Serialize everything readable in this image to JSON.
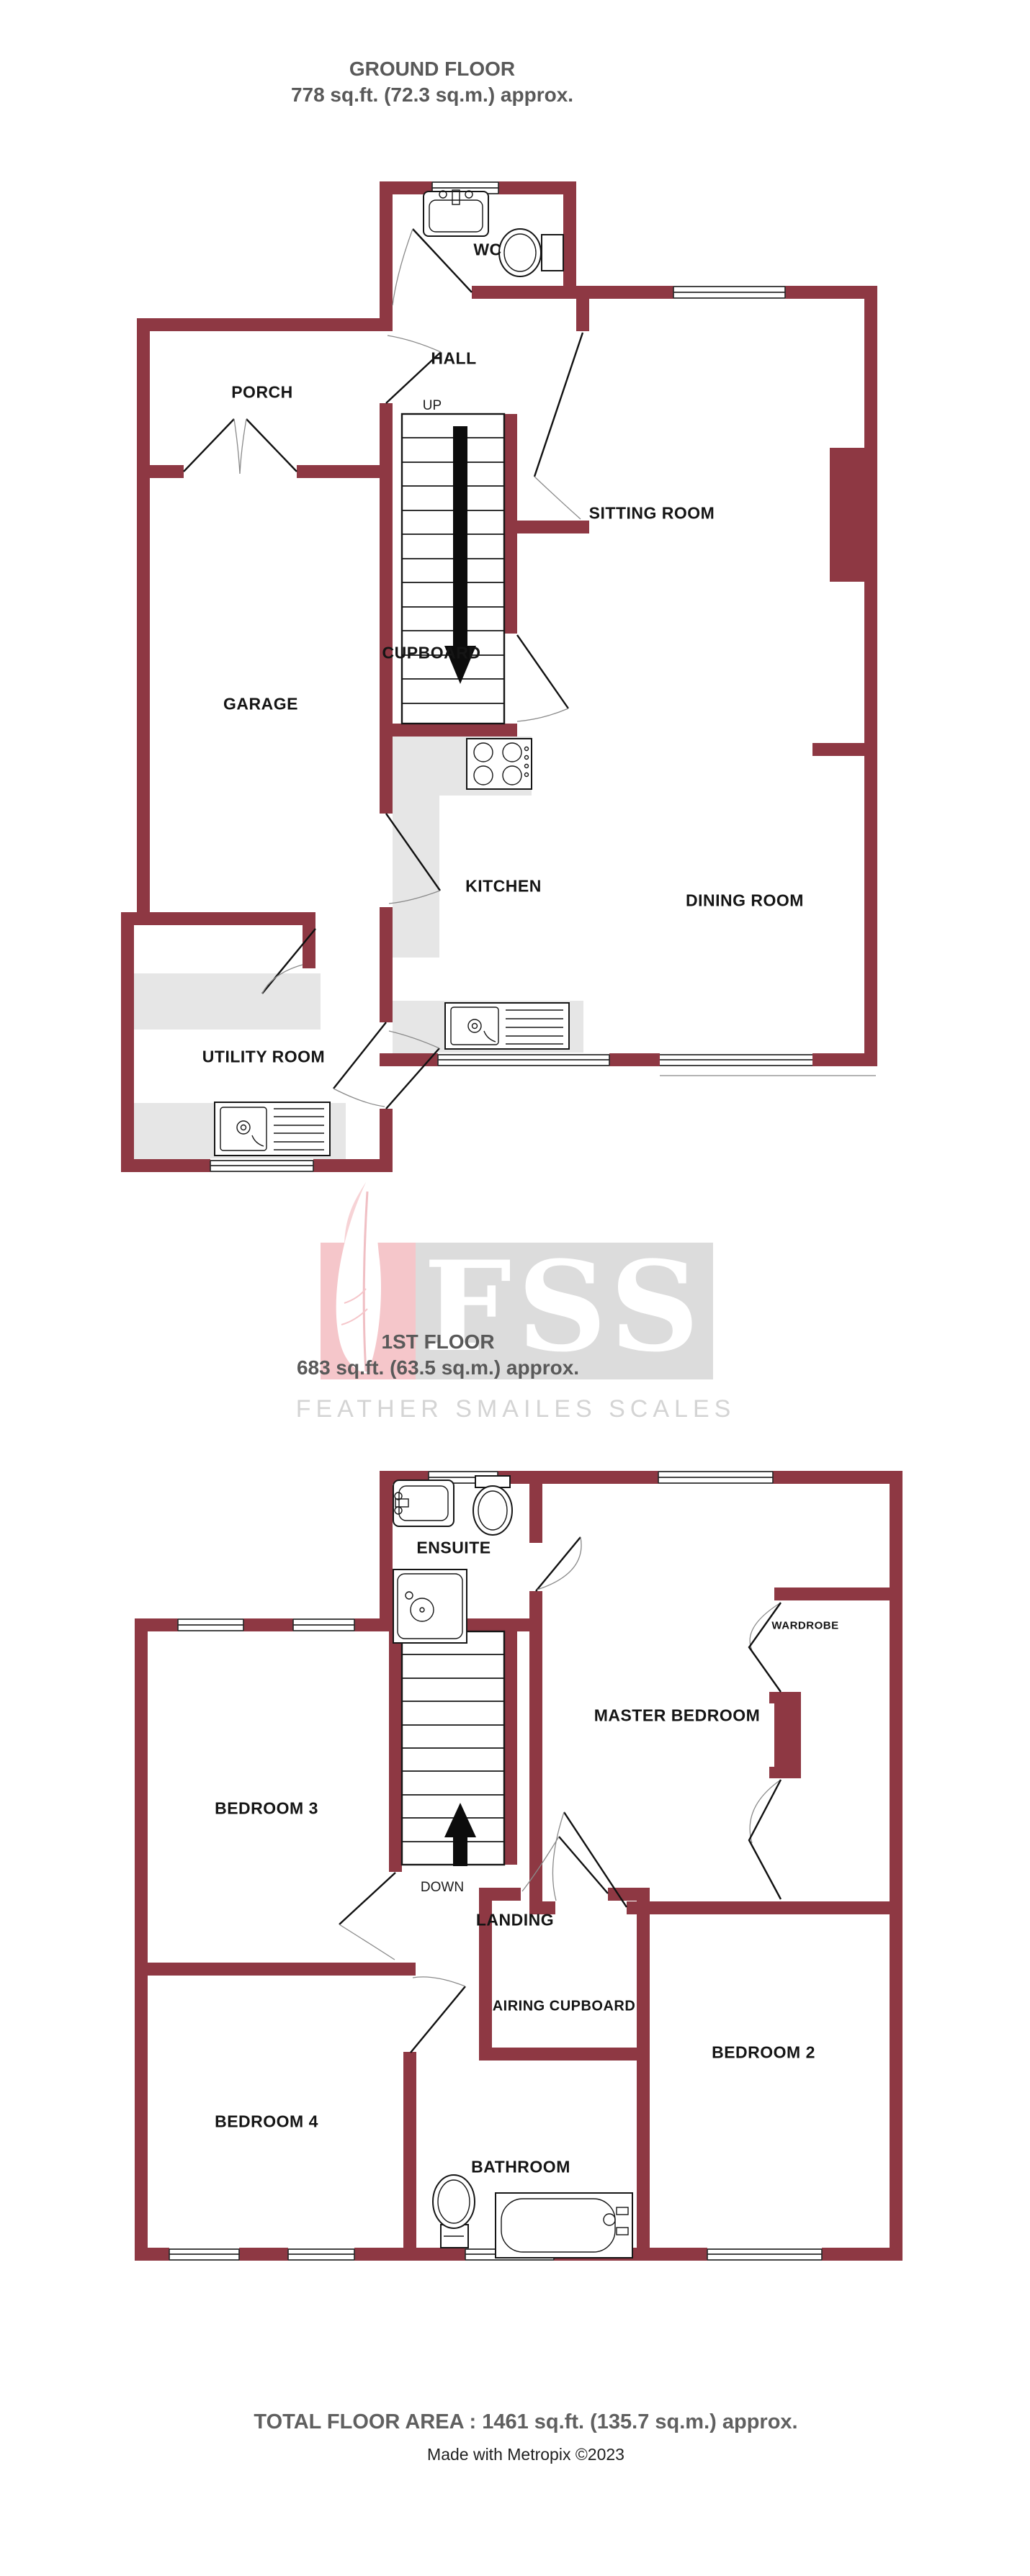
{
  "ground_floor": {
    "title": "GROUND FLOOR",
    "area": "778 sq.ft. (72.3 sq.m.) approx.",
    "stair_label": "UP",
    "rooms": [
      {
        "label": "WC"
      },
      {
        "label": "HALL"
      },
      {
        "label": "PORCH"
      },
      {
        "label": "SITTING ROOM"
      },
      {
        "label": "CUPBOARD"
      },
      {
        "label": "GARAGE"
      },
      {
        "label": "KITCHEN"
      },
      {
        "label": "DINING ROOM"
      },
      {
        "label": "UTILITY ROOM"
      }
    ]
  },
  "first_floor": {
    "title": "1ST FLOOR",
    "area": "683 sq.ft. (63.5 sq.m.) approx.",
    "stair_label": "DOWN",
    "rooms": [
      {
        "label": "ENSUITE"
      },
      {
        "label": "MASTER BEDROOM"
      },
      {
        "label": "WARDROBE"
      },
      {
        "label": "BEDROOM 3"
      },
      {
        "label": "LANDING"
      },
      {
        "label": "AIRING CUPBOARD"
      },
      {
        "label": "BEDROOM 2"
      },
      {
        "label": "BEDROOM 4"
      },
      {
        "label": "BATHROOM"
      }
    ]
  },
  "watermark": {
    "initials": "FSS",
    "name": "FEATHER SMAILES SCALES"
  },
  "footer": {
    "total_area": "TOTAL FLOOR AREA : 1461 sq.ft. (135.7 sq.m.) approx.",
    "credit": "Made with Metropix ©2023"
  },
  "colors": {
    "wall": "#8e3843",
    "counter": "#e6e6e6",
    "title_text": "#595959",
    "watermark_gray": "#dcdcdc",
    "watermark_pink": "#f5c6ca",
    "watermark_text": "#d4d4d4"
  }
}
